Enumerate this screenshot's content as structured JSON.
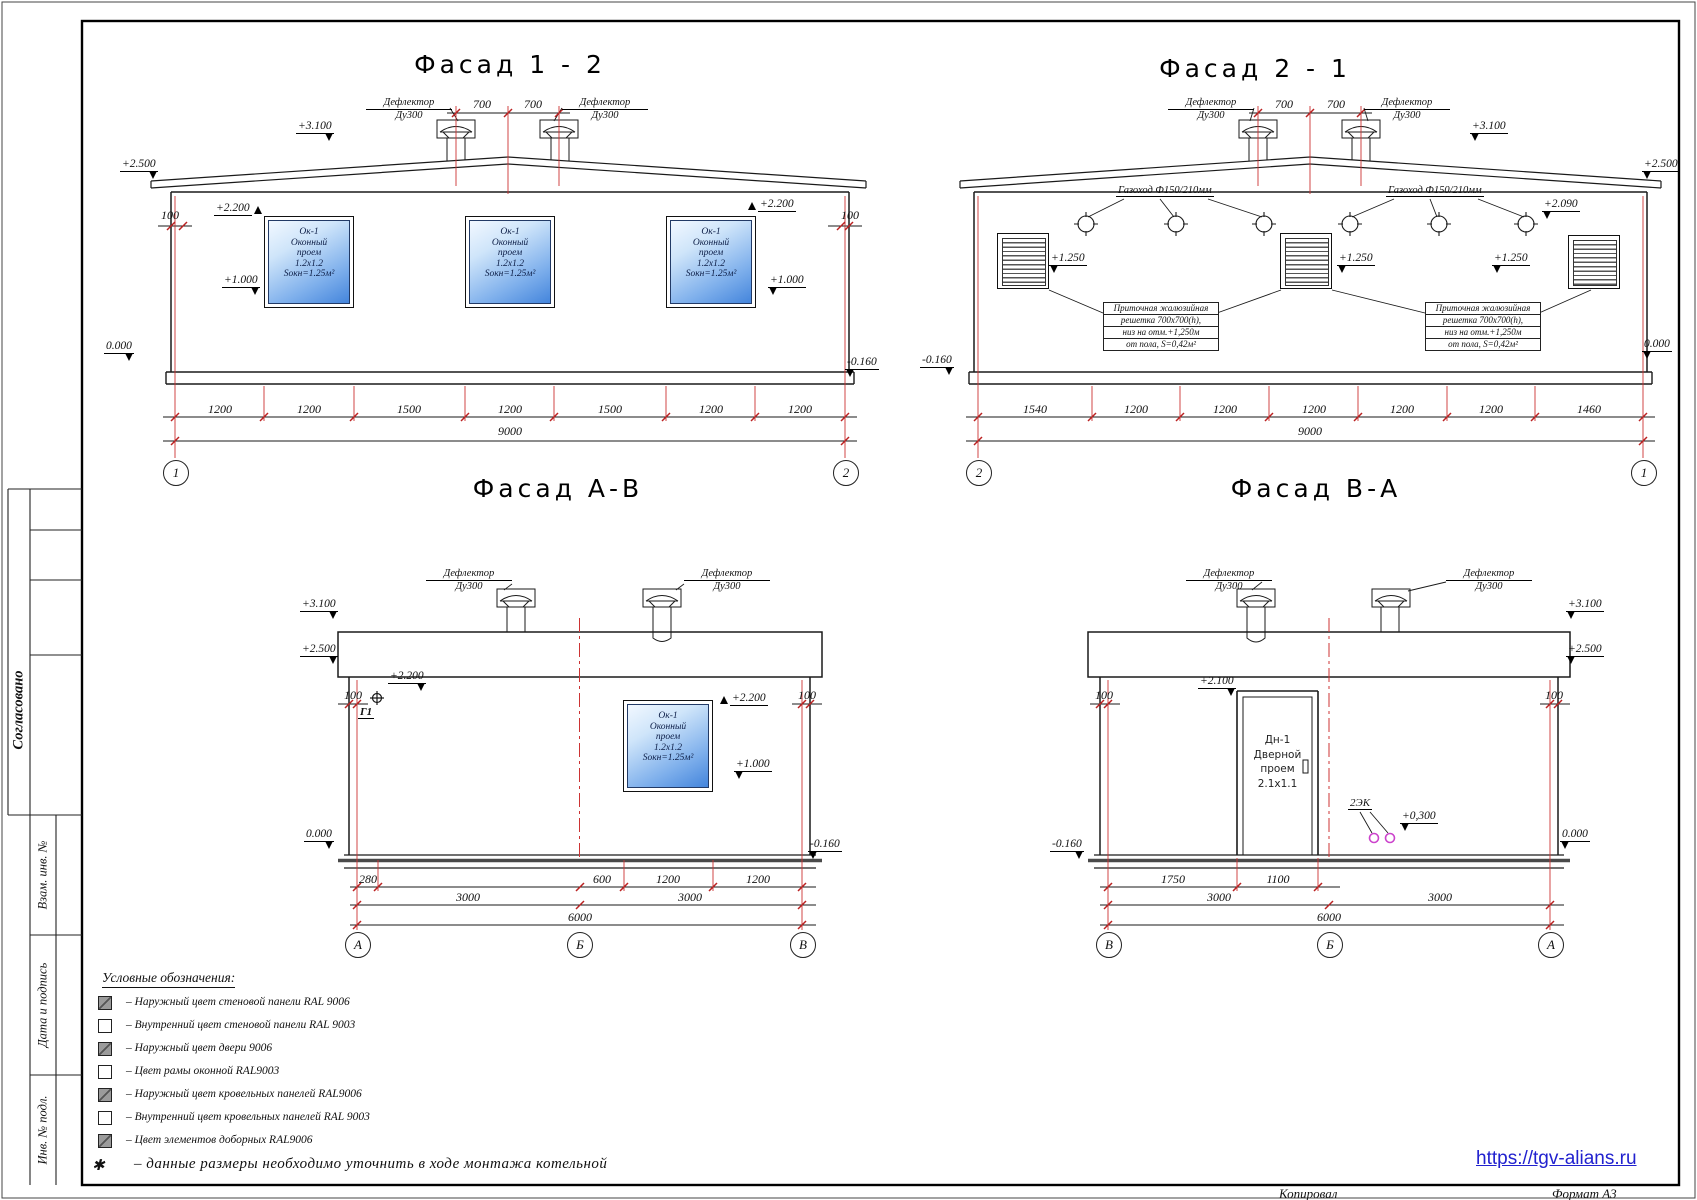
{
  "sheet": {
    "facade12": {
      "title": "Фасад  1 - 2",
      "roof_dims": [
        "700",
        "700"
      ],
      "dims": [
        "1200",
        "1200",
        "1500",
        "1200",
        "1500",
        "1200",
        "1200"
      ],
      "total": "9000",
      "axes": [
        "1",
        "2"
      ]
    },
    "facade21": {
      "title": "Фасад  2 - 1",
      "roof_dims": [
        "700",
        "700"
      ],
      "dims": [
        "1540",
        "1200",
        "1200",
        "1200",
        "1200",
        "1200",
        "1460"
      ],
      "total": "9000",
      "axes": [
        "2",
        "1"
      ],
      "gas_duct": "Газоход Ф150/210мм",
      "grille_note": [
        "Приточная жалюзийная",
        "решетка 700х700(h),",
        "низ на отм.+1,250м",
        "от пола, S=0,42м²"
      ]
    },
    "facadeAB": {
      "title": "Фасад  А-В",
      "dims1": [
        "280",
        "600",
        "1200",
        "1200"
      ],
      "dims2": [
        "3000",
        "3000"
      ],
      "total": "6000",
      "axes": [
        "А",
        "Б",
        "В"
      ],
      "gas_entry": "Г1"
    },
    "facadeBA": {
      "title": "Фасад  В-А",
      "dims1": [
        "1750",
        "1100"
      ],
      "dims2": [
        "3000",
        "3000"
      ],
      "total": "6000",
      "axes": [
        "В",
        "Б",
        "А"
      ],
      "cable": "2ЭК"
    },
    "window": [
      "Ок-1",
      "Оконный",
      "проем",
      "1.2х1.2",
      "Sокн=1.25м²"
    ],
    "door": [
      "Дн-1",
      "Дверной",
      "проем",
      "2.1х1.1"
    ],
    "deflector": [
      "Дефлектор",
      "Ду300"
    ],
    "levels": {
      "p3100": "+3.100",
      "p2500": "+2.500",
      "p2200": "+2.200",
      "p2100": "+2.100",
      "p2090": "+2.090",
      "p1250": "+1.250",
      "p1000": "+1.000",
      "p0300": "+0,300",
      "zero": "0.000",
      "m016": "-0.160",
      "gap": "100"
    }
  },
  "legend": {
    "title": "Условные обозначения:",
    "items": [
      {
        "swatch": "gray",
        "label": "– Наружный цвет стеновой панели RAL 9006"
      },
      {
        "swatch": "white",
        "label": "– Внутренний цвет стеновой панели RAL  9003"
      },
      {
        "swatch": "gray",
        "label": "– Наружный цвет двери 9006"
      },
      {
        "swatch": "white",
        "label": "– Цвет рамы оконной RAL9003"
      },
      {
        "swatch": "gray",
        "label": "– Наружный цвет кровельных панелей  RAL9006"
      },
      {
        "swatch": "white",
        "label": "– Внутренний цвет кровельных панелей RAL 9003"
      },
      {
        "swatch": "gray",
        "label": "– Цвет элементов доборных RAL9006"
      }
    ],
    "footnote_mark": "✱",
    "footnote": "–  данные размеры необходимо уточнить в ходе монтажа котельной"
  },
  "titleblock": {
    "approved": "Согласовано",
    "rows": [
      "Взам. инв. №",
      "Дата и подпись",
      "Инв. № подл."
    ]
  },
  "footer": {
    "copied": "Копировал",
    "format": "Формат А3",
    "website": "https://tgv-alians.ru"
  },
  "colors": {
    "axis_red": "#cc3333",
    "link_blue": "#2121cf",
    "window_blue": "#4485dc",
    "magenta": "#cc44cc"
  }
}
